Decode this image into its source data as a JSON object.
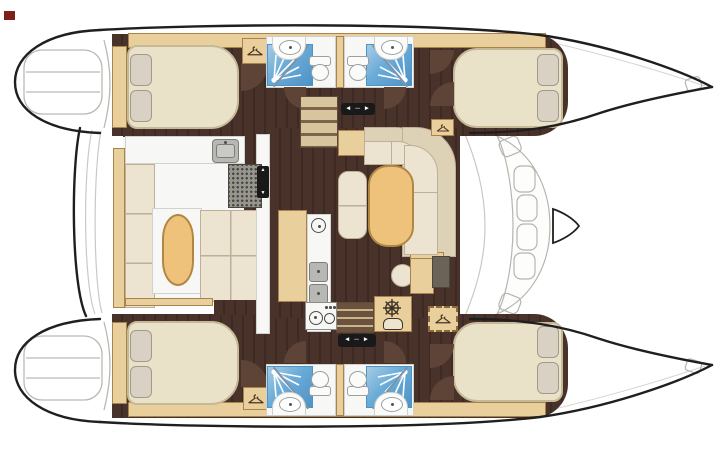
{
  "meta": {
    "description": "Catamaran yacht accommodation floor plan, top view, bows to the right",
    "view": "overhead deck plan"
  },
  "counts": {
    "double_cabins": 4,
    "shower_rooms": 4,
    "toilets": 4,
    "helm_stations": 1
  },
  "icons": {
    "wardrobe": "clothes-hanger",
    "helm": "ships-wheel",
    "shower": "spray-jets",
    "slider_h": "◄ ─ ►",
    "slider_v_up": "▲",
    "slider_v_down": "▼"
  },
  "colors": {
    "paper": "#ffffff",
    "outline": "#1f1f1f",
    "deck_line": "#b9b9b3",
    "faint_line": "#d5d5d0",
    "wood_floor": "#49322a",
    "wood_floor_deep": "#3e2a24",
    "door_wood": "#5e4337",
    "tan": "#e9cf9c",
    "tan_border": "#a8834d",
    "table_wood": "#eec27b",
    "table_border": "#b18843",
    "cream": "#ece4d0",
    "cream_seam": "#bdb097",
    "back_beige": "#ddd1b6",
    "bed": "#eae1c9",
    "bed_border": "#c6b998",
    "pillow": "#d9d2c4",
    "pillow_border": "#a29a89",
    "white_floor": "#f7f7f5",
    "white_floor_border": "#d2d2cd",
    "shower_blue": "#69abd8",
    "shower_blue_deep": "#4e93c6",
    "shower_blue_light": "#a6cbe4",
    "porcelain": "#fbfbf9",
    "porcelain_border": "#9aa0a4",
    "steel": "#b7b7b3",
    "steel_dark": "#7e7e79",
    "grill": "#96968f",
    "grill_dot": "#4b463f",
    "panel_dark": "#6b6358",
    "badge": "#191919",
    "badge_text": "#ffffff",
    "maroon": "#7c2018"
  }
}
